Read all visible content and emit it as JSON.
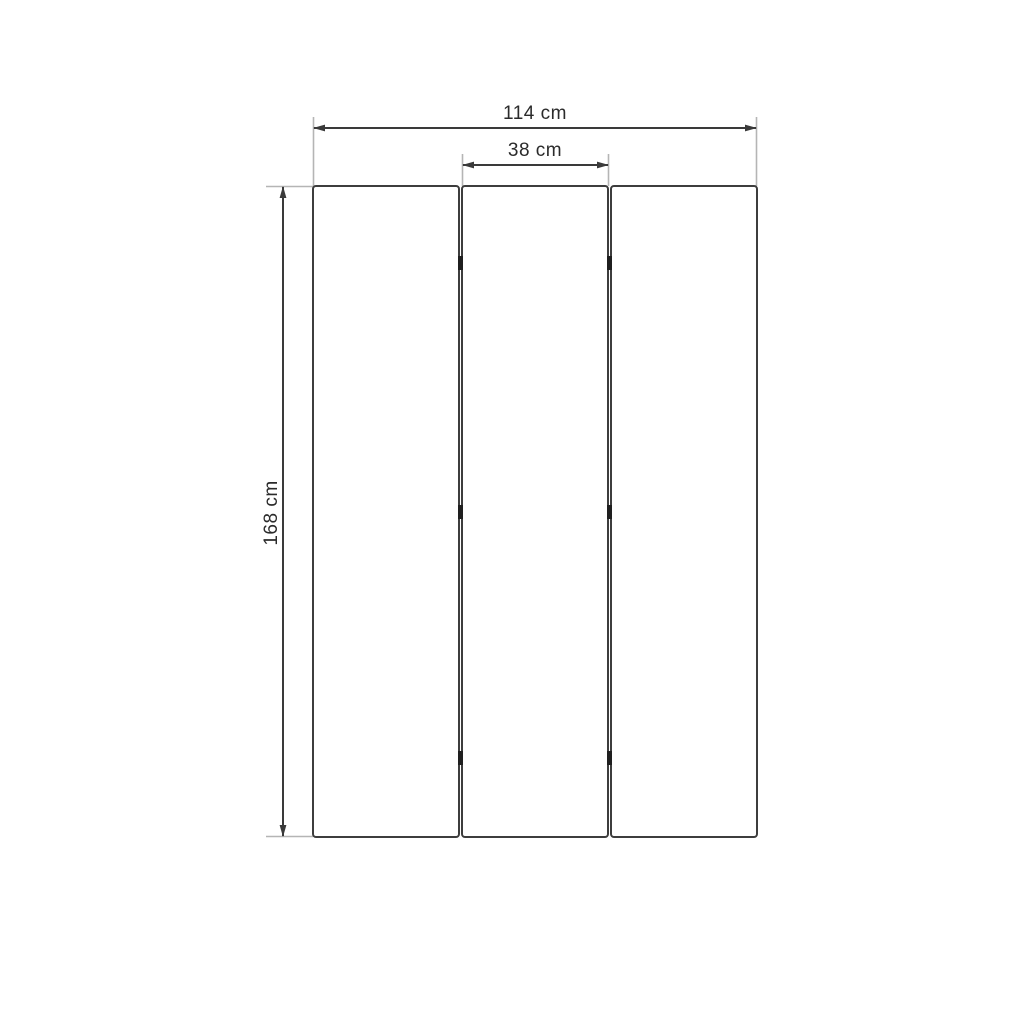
{
  "diagram": {
    "type": "technical-dimension-drawing",
    "subject": "three-panel folding screen / room divider, front view",
    "panels": {
      "count": 3
    },
    "hinges": {
      "gaps": 2,
      "per_gap": 3
    },
    "dimensions": {
      "total_width": {
        "label": "114 cm"
      },
      "panel_width": {
        "label": "38 cm"
      },
      "height": {
        "label": "168 cm"
      }
    },
    "colors": {
      "background": "#ffffff",
      "panel_stroke": "#3d3d3d",
      "panel_fill": "#ffffff",
      "dimension_line": "#3a3a3a",
      "extension_line": "#b5b5b5",
      "hinge": "#1f1f1f",
      "text": "#2b2b2b"
    }
  }
}
